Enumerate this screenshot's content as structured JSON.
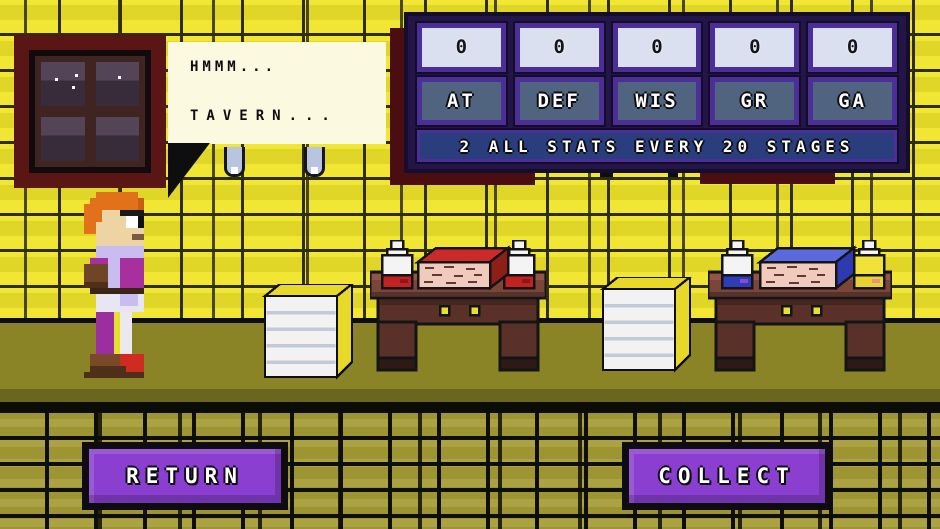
{
  "dialogue": {
    "lines": [
      "HMMM...",
      "TAVERN..."
    ]
  },
  "hud": {
    "stats": [
      {
        "value": "0",
        "label": "AT"
      },
      {
        "value": "0",
        "label": "DEF"
      },
      {
        "value": "0",
        "label": "WIS"
      },
      {
        "value": "0",
        "label": "GR"
      },
      {
        "value": "0",
        "label": "GA"
      }
    ],
    "footer": "2 ALL STATS EVERY 20 STAGES"
  },
  "actions": {
    "return_label": "RETURN",
    "collect_label": "COLLECT"
  },
  "colors": {
    "wall": "#f0e633",
    "floor": "#8a8426",
    "floor-dark": "#6b661d",
    "lower-tile": "#9d9432",
    "maroon": "#4a0e10",
    "bubble": "#fbf9e0",
    "panel-bg": "#231646",
    "panel-border": "#4c2e99",
    "value-box": "#dae0f0",
    "label-box": "#50647f",
    "footer-bar": "#2a3d7d",
    "button": "#8a3fd0"
  }
}
